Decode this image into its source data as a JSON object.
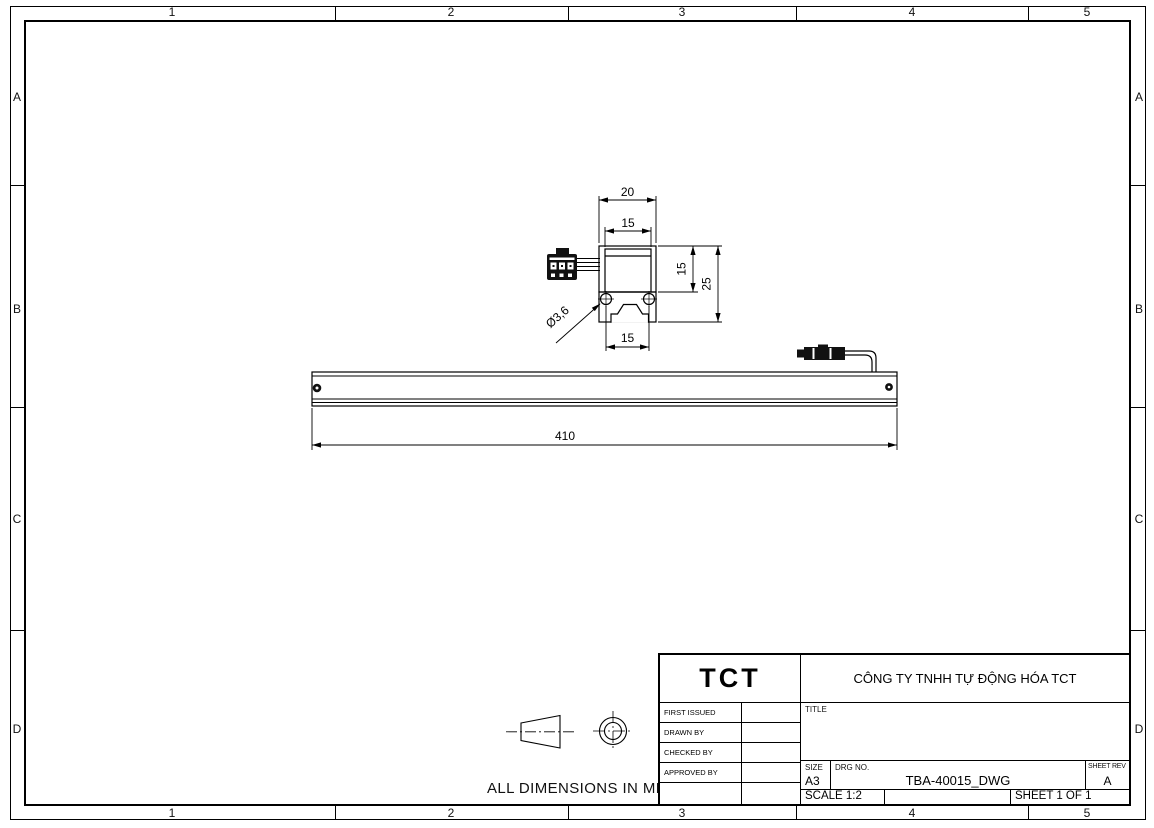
{
  "sheet": {
    "zone_columns": [
      "1",
      "2",
      "3",
      "4",
      "5"
    ],
    "zone_rows": [
      "A",
      "B",
      "C",
      "D"
    ],
    "note": "ALL DIMENSIONS IN MM"
  },
  "colors": {
    "ink": "#000000",
    "background": "#ffffff"
  },
  "drawing": {
    "dims": {
      "base_width": "20",
      "body_width": "15",
      "body_height": "15",
      "overall_height": "25",
      "hole_dia": "Ø3,6",
      "hole_spacing": "15",
      "length": "410"
    }
  },
  "title_block": {
    "logo": "TCT",
    "company": "CÔNG TY TNHH TỰ ĐỘNG HÓA TCT",
    "approval_rows": [
      {
        "label": "FIRST ISSUED",
        "value": ""
      },
      {
        "label": "DRAWN BY",
        "value": ""
      },
      {
        "label": "CHECKED BY",
        "value": ""
      },
      {
        "label": "APPROVED BY",
        "value": ""
      },
      {
        "label": "",
        "value": ""
      }
    ],
    "title_label": "TITLE",
    "title_value": "",
    "size_label": "SIZE",
    "size_value": "A3",
    "drg_no_label": "DRG NO.",
    "drg_no_value": "TBA-40015_DWG",
    "sheet_rev_label": "SHEET REV",
    "sheet_rev_value": "A",
    "scale": "SCALE 1:2",
    "sheet_of": "SHEET 1 OF 1"
  }
}
